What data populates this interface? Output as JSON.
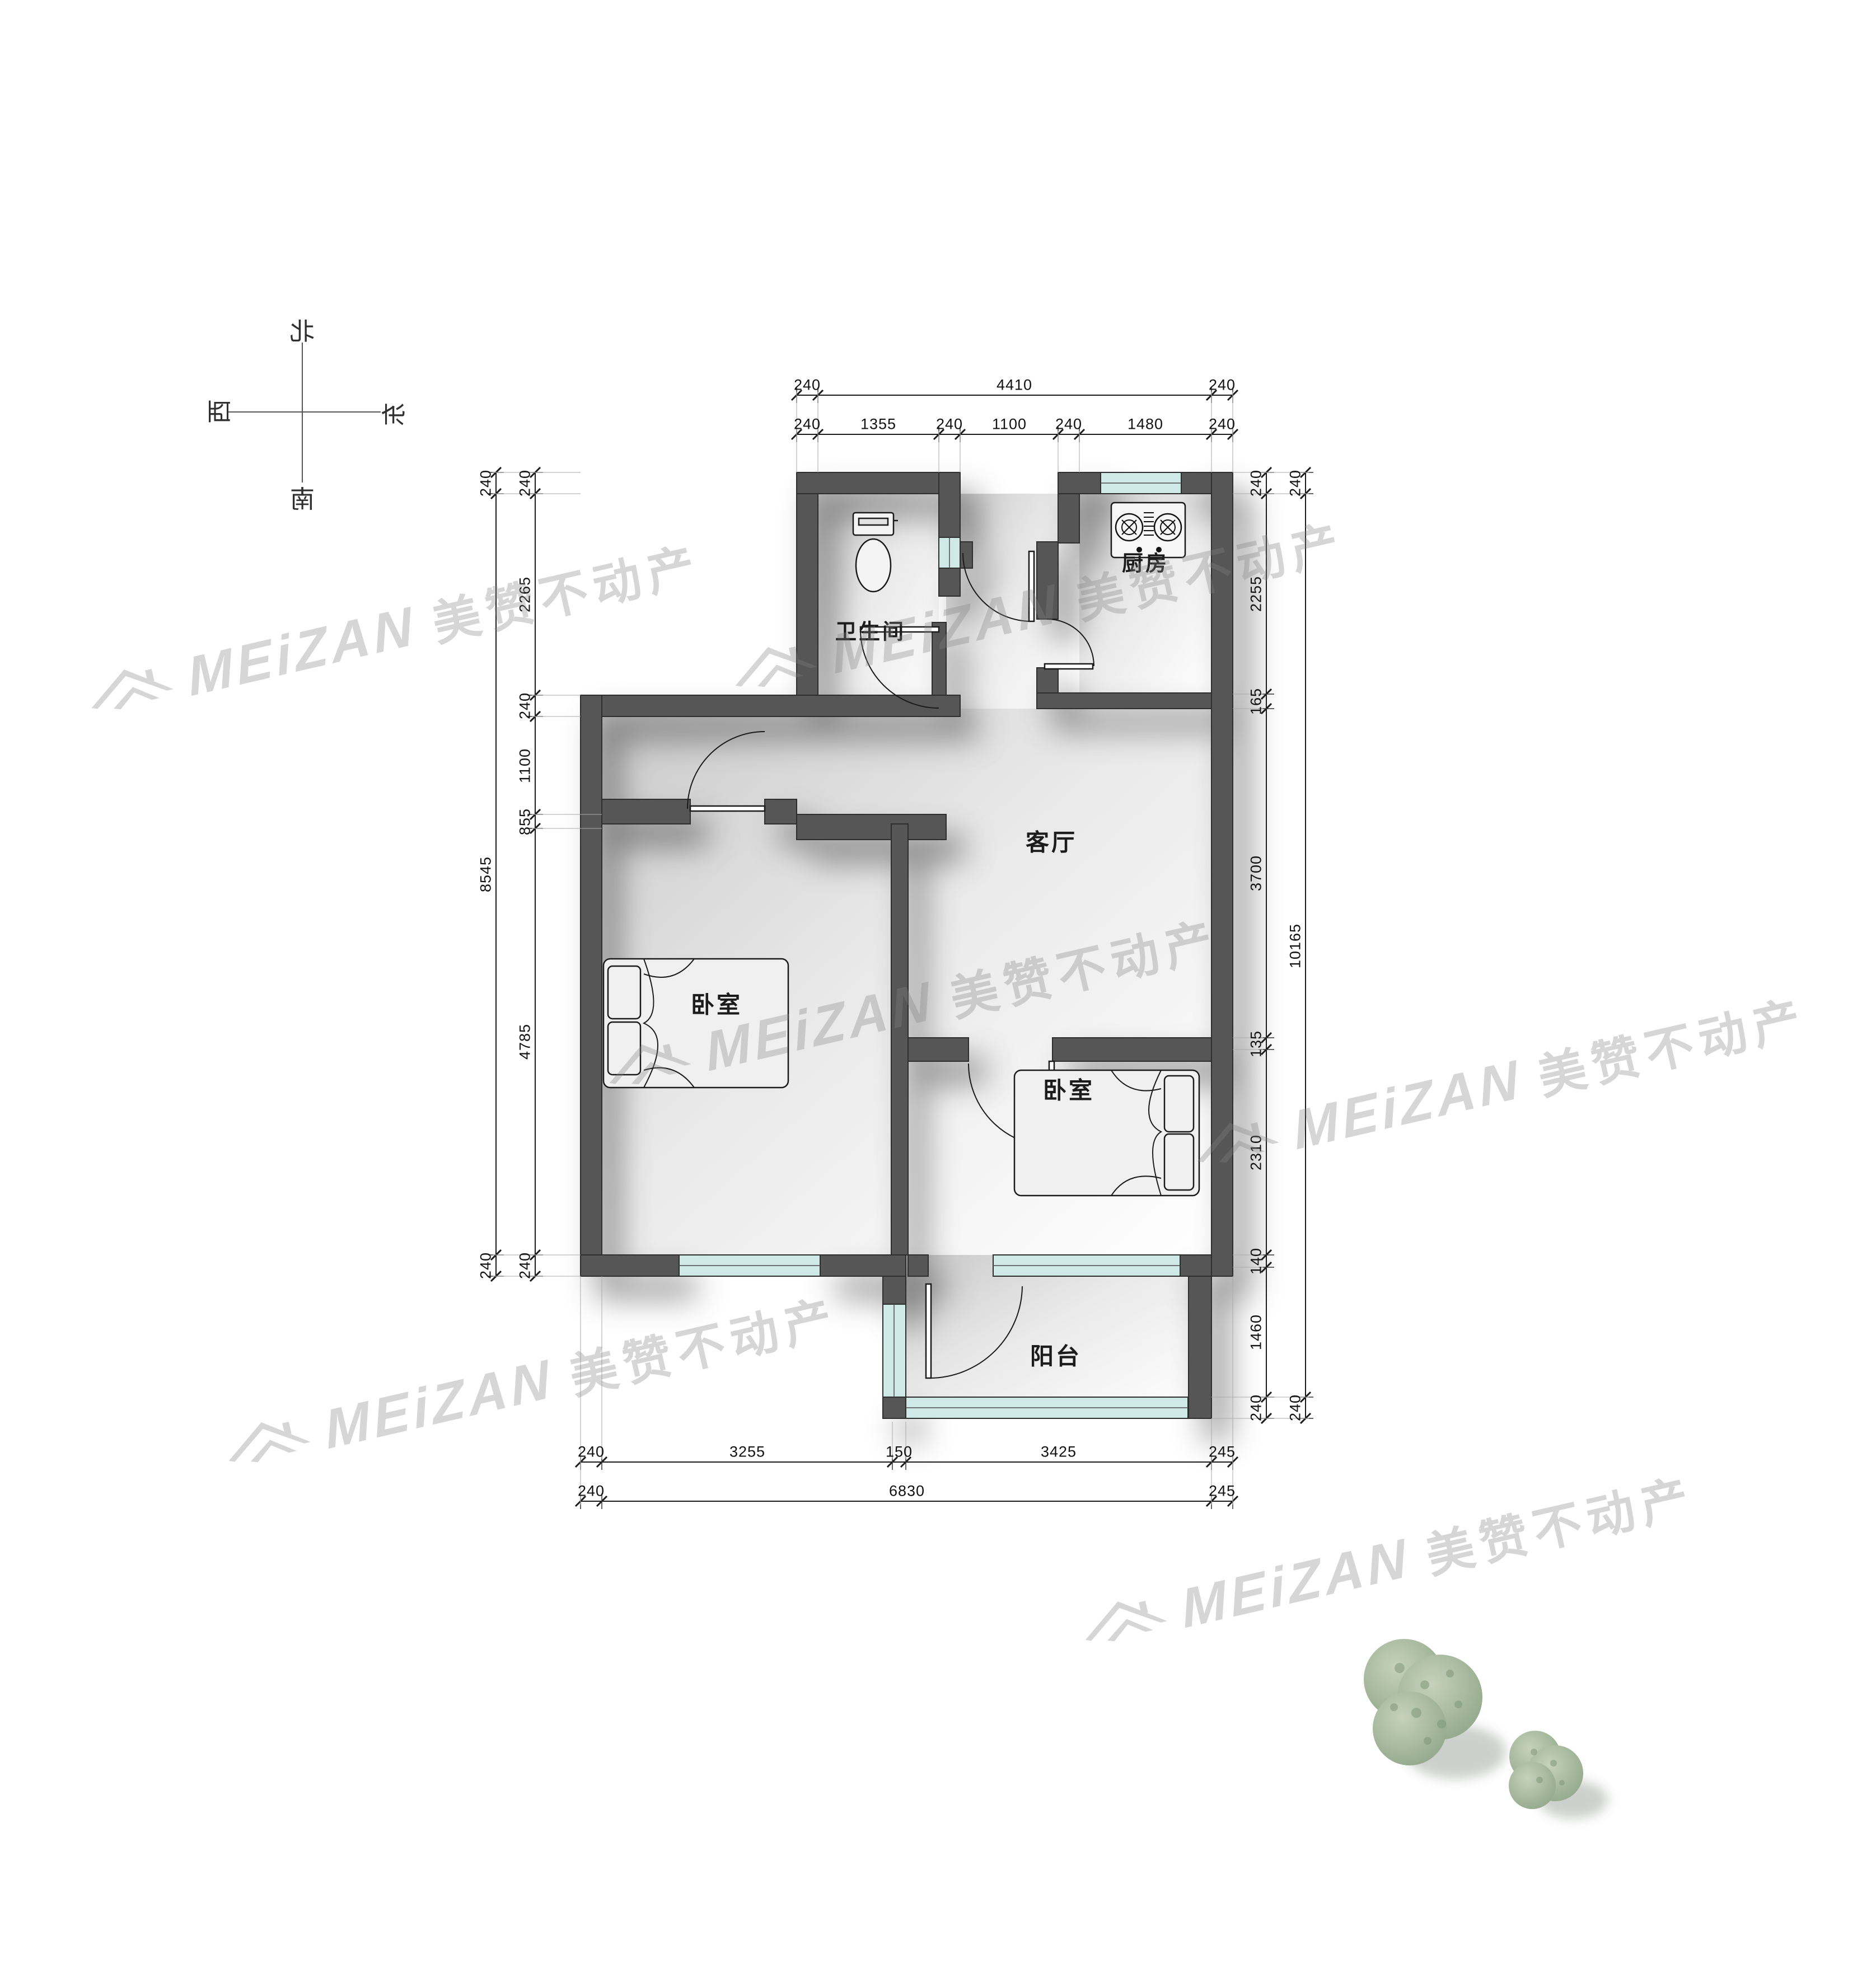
{
  "compass": {
    "north": "北",
    "south": "南",
    "west": "西",
    "east": "东"
  },
  "rooms": {
    "bathroom": "卫生间",
    "kitchen": "厨房",
    "living": "客厅",
    "bedroom_left": "卧室",
    "bedroom_right": "卧室",
    "balcony": "阳台"
  },
  "watermark": {
    "latin": "MEiZAN",
    "cn": "美赞不动产"
  },
  "dims": {
    "top_outer": [
      "240",
      "4410",
      "240"
    ],
    "top_inner": [
      "240",
      "1355",
      "240",
      "1100",
      "240",
      "1480",
      "240"
    ],
    "left_outer": [
      "240",
      "8545",
      "240"
    ],
    "left_inner": [
      "240",
      "2265",
      "240",
      "1100",
      "855",
      "4785",
      "240"
    ],
    "right_inner": [
      "240",
      "2255",
      "165",
      "3700",
      "135",
      "2310",
      "140",
      "1460",
      "240"
    ],
    "right_outer": [
      "240",
      "10165",
      "240"
    ],
    "bottom_inner": [
      "240",
      "3255",
      "150",
      "3425",
      "245"
    ],
    "bottom_outer": [
      "240",
      "6830",
      "245"
    ]
  },
  "colors": {
    "wall": "#565656",
    "window_glass": "#cfe9e6",
    "dimension": "#111111",
    "watermark": "#828282",
    "tree": "#a3b69a"
  }
}
